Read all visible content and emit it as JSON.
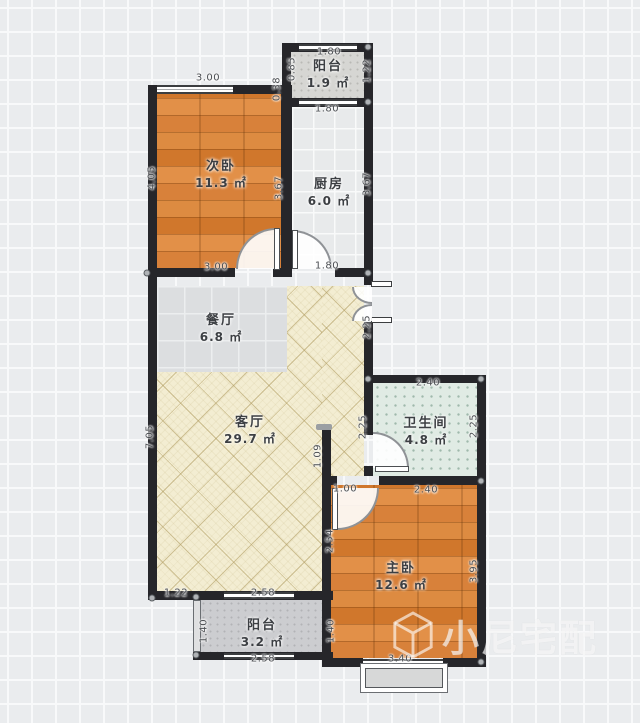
{
  "unit": "㎡",
  "rooms": [
    {
      "name": "阳台",
      "area": "1.9"
    },
    {
      "name": "次卧",
      "area": "11.3"
    },
    {
      "name": "厨房",
      "area": "6.0"
    },
    {
      "name": "餐厅",
      "area": "6.8"
    },
    {
      "name": "客厅",
      "area": "29.7"
    },
    {
      "name": "卫生间",
      "area": "4.8"
    },
    {
      "name": "主卧",
      "area": "12.6"
    },
    {
      "name": "阳台",
      "area": "3.2"
    }
  ],
  "dims": [
    "3.00",
    "1.80",
    "0.85",
    "1.22",
    "0.38",
    "1.80",
    "4.05",
    "3.67",
    "3.67",
    "3.00",
    "1.80",
    "2.25",
    "7.05",
    "2.40",
    "2.25",
    "2.25",
    "1.09",
    "1.00",
    "2.40",
    "2.54",
    "3.95",
    "1.22",
    "2.58",
    "1.40",
    "1.40",
    "2.58",
    "3.40"
  ],
  "watermark": {
    "brand": "小尼宅配",
    "logo": "cube-logo"
  },
  "colors": {
    "wall": "#26262a",
    "wood": "#d9853c",
    "living": "#f3edd2",
    "bath": "#e0ebe4",
    "grid": "#f8f9fa"
  }
}
